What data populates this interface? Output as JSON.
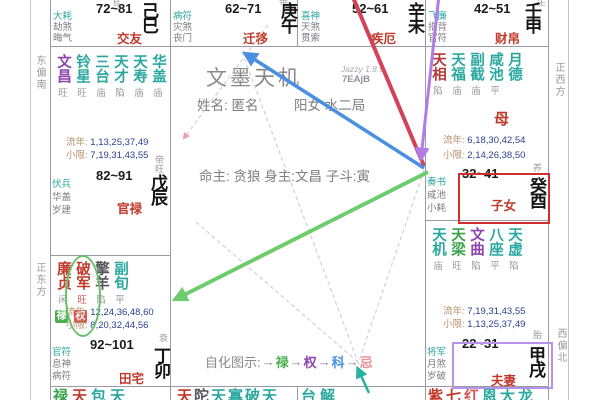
{
  "app": {
    "title": "文墨天机",
    "version": "Jazzy 1.8.6",
    "code": "7EAjB"
  },
  "profile": {
    "name_line": "姓名: 匿名",
    "info_line": "阳女 水二局",
    "masters_line": "命主: 贪狼 身主:文昌 子斗:寅"
  },
  "legend": {
    "label": "自化图示:",
    "arrow": "→",
    "items": [
      {
        "ch": "禄",
        "color": "#4caf50"
      },
      {
        "ch": "权",
        "color": "#8e44ad"
      },
      {
        "ch": "科",
        "color": "#4a8fe0"
      },
      {
        "ch": "忌",
        "color": "#e8919b"
      }
    ]
  },
  "directions": {
    "left_top": "东偏南",
    "left_bottom": "正东方",
    "right_top": "正西方",
    "right_bottom": "西偏北"
  },
  "colors": {
    "highlight_red": "#cf2f2f",
    "highlight_purple": "#b792ea",
    "arrow_lu": "#6ecc6e",
    "arrow_quan": "#b07ce8",
    "arrow_ke": "#4a8fe0",
    "arrow_ji": "#d24357"
  },
  "palaces": {
    "si": {
      "branch": "己巳",
      "name": "交友",
      "age": "72~81",
      "minors": [
        "大耗",
        "劫煞",
        "晦气"
      ],
      "state_clip": "官"
    },
    "wu": {
      "branch": "庚午",
      "name": "迁移",
      "age": "62~71",
      "minors": [
        "病符",
        "灾煞",
        "丧门"
      ],
      "state_clip": "带"
    },
    "wei": {
      "branch": "辛未",
      "name": "疾厄",
      "age": "52~61",
      "minors": [
        "喜神",
        "天煞",
        "贯索"
      ]
    },
    "shen": {
      "branch": "壬申",
      "name": "财帛",
      "age": "42~51",
      "minors": [
        "飞廉",
        "指背",
        "官符"
      ],
      "state_clip": "生"
    },
    "you": {
      "branch": "癸酉",
      "name": "子女",
      "age": "32~41",
      "state": "养",
      "special": "母",
      "minors": [
        "奏书",
        "咸池",
        "小耗"
      ],
      "stars": [
        {
          "n": "天相",
          "s": "陷",
          "c": "#b03a3a"
        },
        {
          "n": "天福",
          "s": "庙",
          "c": "#2aa8a0"
        },
        {
          "n": "副截",
          "s": "庙",
          "c": "#2aa8a0"
        },
        {
          "n": "咸池",
          "s": "平",
          "c": "#2aa8a0"
        },
        {
          "n": "月德",
          "s": "",
          "c": "#2aa8a0"
        }
      ],
      "ln_label": "流年:",
      "ln_vals": "6,18,30,42,54",
      "xx_label": "小限:",
      "xx_vals": "2,14,26,38,50"
    },
    "xu": {
      "branch": "甲戌",
      "name": "夫妻",
      "age": "22~31",
      "state": "胎",
      "minors": [
        "将军",
        "月煞",
        "岁破"
      ],
      "stars": [
        {
          "n": "天机",
          "s": "庙",
          "c": "#2aa8a0"
        },
        {
          "n": "天梁",
          "s": "旺",
          "c": "#3aa34a"
        },
        {
          "n": "文曲",
          "s": "陷",
          "c": "#8e44ad"
        },
        {
          "n": "八座",
          "s": "平",
          "c": "#2aa8a0"
        },
        {
          "n": "天虚",
          "s": "陷",
          "c": "#2aa8a0"
        }
      ],
      "ln_label": "流年:",
      "ln_vals": "7,19,31,43,55",
      "xx_label": "小限:",
      "xx_vals": "1,13,25,37,49"
    },
    "chen": {
      "branch": "戊辰",
      "name": "官禄",
      "age": "82~91",
      "state": "帝旺",
      "minors": [
        "伏兵",
        "华盖",
        "岁建"
      ],
      "stars": [
        {
          "n": "文昌",
          "s": "旺",
          "c": "#8e44ad"
        },
        {
          "n": "铃星",
          "s": "旺",
          "c": "#2aa8a0"
        },
        {
          "n": "三台",
          "s": "庙",
          "c": "#2aa8a0"
        },
        {
          "n": "天才",
          "s": "陷",
          "c": "#2aa8a0"
        },
        {
          "n": "天寿",
          "s": "庙",
          "c": "#2aa8a0"
        },
        {
          "n": "华盖",
          "s": "庙",
          "c": "#2aa8a0"
        }
      ],
      "ln_label": "流年:",
      "ln_vals": "1,13,25,37,49",
      "xx_label": "小限:",
      "xx_vals": "7,19,31,43,55"
    },
    "mao": {
      "branch": "丁卯",
      "name": "田宅",
      "age": "92~101",
      "state": "衰",
      "minors": [
        "官符",
        "息神",
        "病符"
      ],
      "stars": [
        {
          "n": "廉贞",
          "s": "闲",
          "c": "#c0392b"
        },
        {
          "n": "破军",
          "s": "旺",
          "c": "#c0392b",
          "s_c": "#d9534f"
        },
        {
          "n": "擎羊",
          "s": "陷",
          "c": "#55555c"
        },
        {
          "n": "副旬",
          "s": "平",
          "c": "#2aa8a0"
        }
      ],
      "badges": [
        {
          "ch": "禄",
          "bg": "#4cae4c"
        },
        {
          "ch": "权",
          "bg": "#d9534f"
        }
      ],
      "ln_label": "流年:",
      "ln_vals": "12,24,36,48,60",
      "xx_label": "小限:",
      "xx_vals": "8,20,32,44,56"
    }
  },
  "bottom_row": {
    "b1": [
      {
        "ch": "禄",
        "c": "#3aa34a"
      },
      {
        "ch": "天",
        "c": "#c0392b"
      },
      {
        "ch": "包",
        "c": "#2aa8a0"
      },
      {
        "ch": "天",
        "c": "#2aa8a0"
      }
    ],
    "b2": [
      {
        "ch": "天",
        "c": "#c0392b"
      },
      {
        "ch": "陀",
        "c": "#55555c"
      },
      {
        "ch": "天",
        "c": "#2aa8a0"
      },
      {
        "ch": "寡",
        "c": "#2aa8a0"
      },
      {
        "ch": "破",
        "c": "#2aa8a0"
      },
      {
        "ch": "天",
        "c": "#2aa8a0"
      }
    ],
    "b3": [
      {
        "ch": "台",
        "c": "#2aa8a0"
      },
      {
        "ch": "解",
        "c": "#2aa8a0"
      }
    ],
    "b4": [
      {
        "ch": "紫",
        "c": "#c0392b"
      },
      {
        "ch": "七",
        "c": "#c0392b"
      },
      {
        "ch": "红",
        "c": "#d9534f"
      },
      {
        "ch": "恩",
        "c": "#2aa8a0"
      },
      {
        "ch": "大",
        "c": "#2aa8a0"
      },
      {
        "ch": "龙",
        "c": "#2aa8a0"
      }
    ]
  }
}
